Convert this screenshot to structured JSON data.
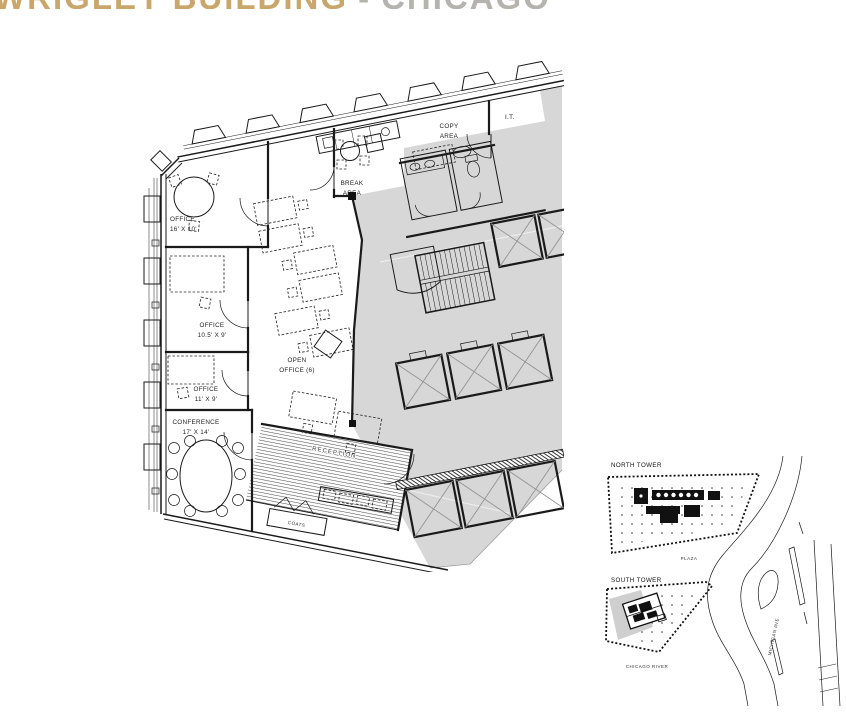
{
  "title": {
    "left": "WRIGLEY BUILDING",
    "separator": "-",
    "right": "CHICAGO"
  },
  "floor_plan": {
    "office_a": {
      "line1": "OFFICE",
      "line2": "16' X 10'"
    },
    "office_b": {
      "line1": "OFFICE",
      "line2": "10.5' X 9'"
    },
    "office_c": {
      "line1": "OFFICE",
      "line2": "11' X 9'"
    },
    "conference": {
      "line1": "CONFERENCE",
      "line2": "17' X 14'"
    },
    "open_office": {
      "line1": "OPEN",
      "line2": "OFFICE (6)"
    },
    "break_area": {
      "line1": "BREAK",
      "line2": "AREA"
    },
    "copy_area": {
      "line1": "COPY",
      "line2": "AREA"
    },
    "it_room": {
      "label": "I.T."
    },
    "reception": {
      "label": "RECEPTION"
    },
    "coats": {
      "label": "COATS"
    }
  },
  "site_plan": {
    "north_tower_label": "NORTH TOWER",
    "south_tower_label": "SOUTH TOWER",
    "plaza_label": "PLAZA",
    "river_label": "CHICAGO RIVER",
    "street_label": "MICHIGAN AVE"
  },
  "colors": {
    "title_tan": "#c9a66b",
    "title_gray": "#b5b3ae",
    "line": "#1a1a1a",
    "core_fill": "#d7d7d7"
  }
}
